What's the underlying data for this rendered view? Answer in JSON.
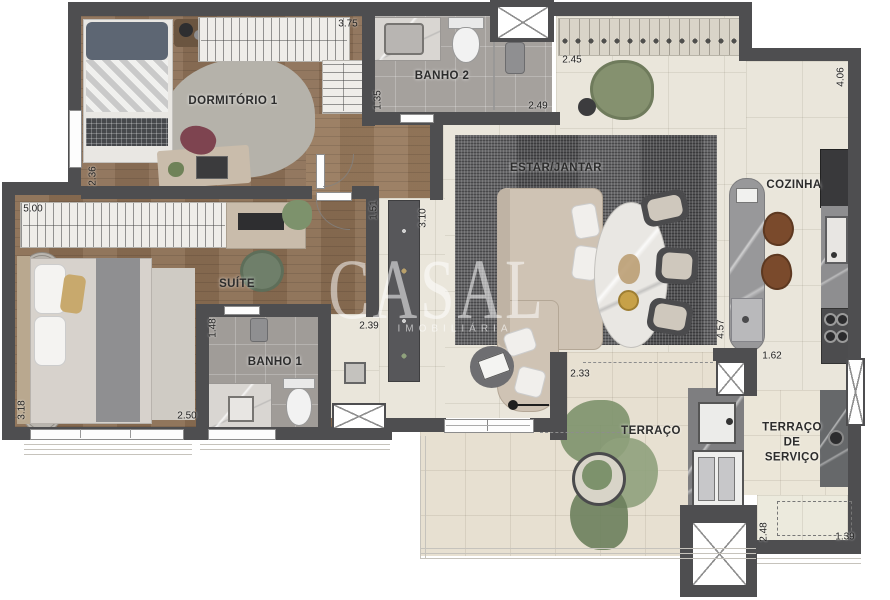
{
  "rooms": {
    "dormitorio1": "DORMITÓRIO 1",
    "banho2": "BANHO 2",
    "suite": "SUÍTE",
    "banho1": "BANHO 1",
    "estar": "ESTAR/JANTAR",
    "cozinha": "COZINHA",
    "terraco": "TERRAÇO",
    "terraco_servico": "TERRAÇO\nDE\nSERVIÇO"
  },
  "dims": {
    "dormitorio_width": "3.75",
    "dormitorio_depth": "2.36",
    "banho2_depth": "1.35",
    "banho2_width": "2.49",
    "estar_top": "2.45",
    "cozinha_depth": "4.06",
    "suite_width": "5.00",
    "hall_width": "1.51",
    "hall_depth": "3.10",
    "banho1_door": "1.48",
    "banho1_width": "2.39",
    "suite_depth": "2.50",
    "suite_side": "3.18",
    "terraco_opening": "2.33",
    "island_length": "4.57",
    "cozinha_aisle": "1.62",
    "servico_depth": "2.48",
    "servico_width": "1.39"
  },
  "watermark": {
    "name": "CASAL",
    "subtitle": "IMOBILIÁRIA"
  },
  "colors": {
    "wall": "#4e4e50",
    "wood_floor": "#8c7056",
    "tile_floor": "#eae6db",
    "bath_floor": "#a5a19d",
    "terrace_floor": "#e7e0d1",
    "plant_green": "#7d926c",
    "sofa_beige": "#cfc3b4"
  }
}
